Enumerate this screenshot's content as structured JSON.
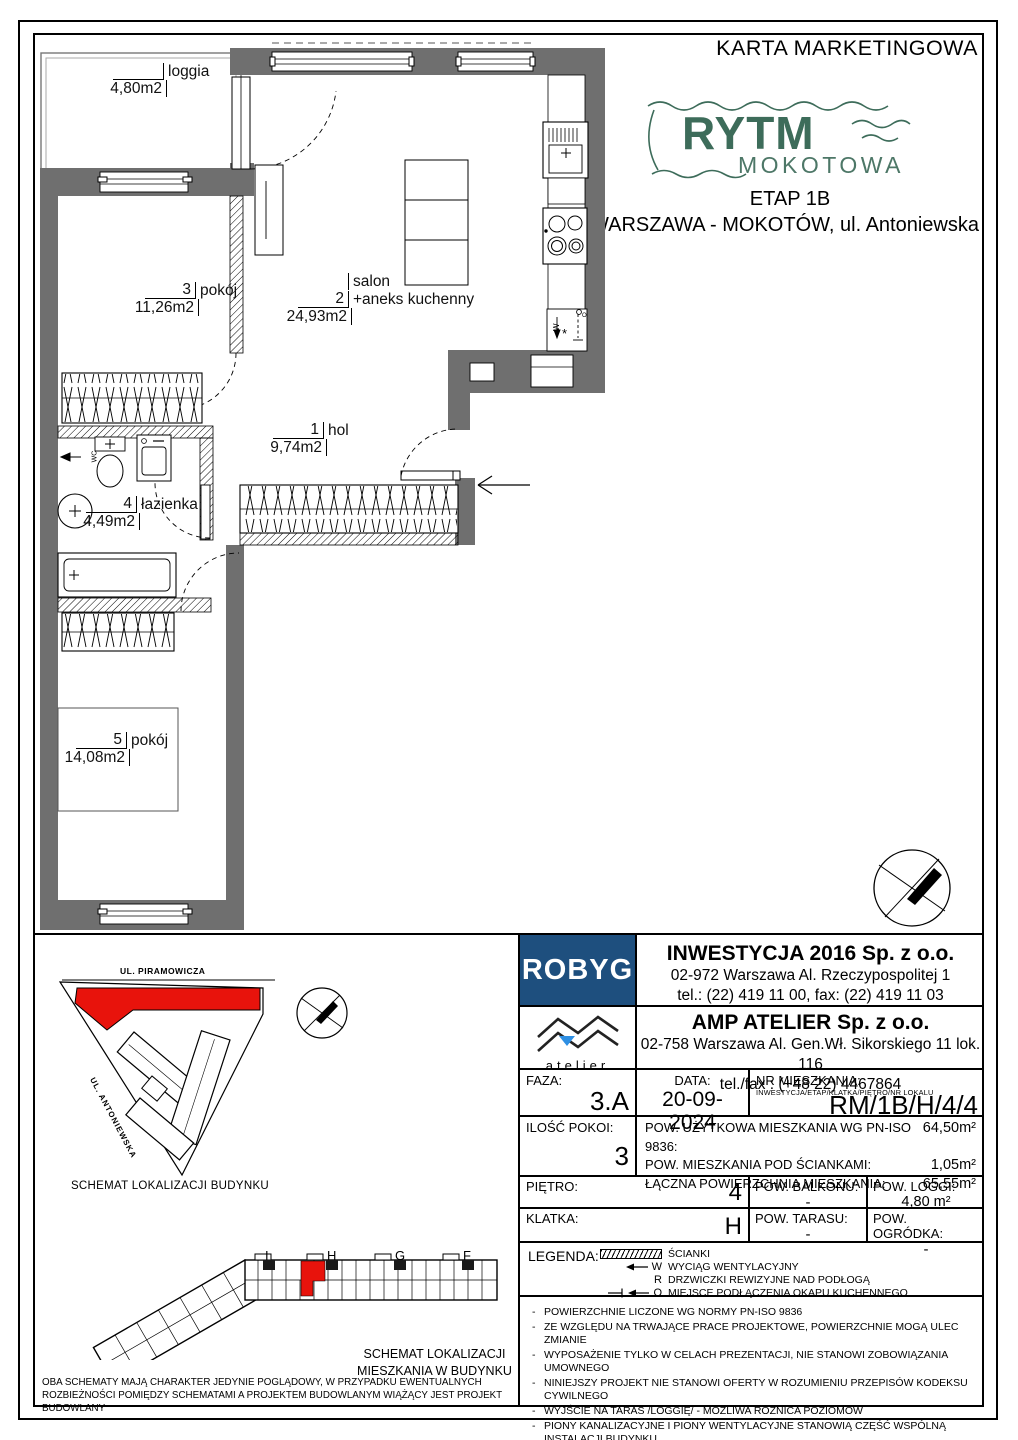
{
  "header": {
    "title": "KARTA MARKETINGOWA",
    "etap": "ETAP 1B",
    "location": "WARSZAWA - MOKOTÓW, ul. Antoniewska"
  },
  "brand": {
    "line1": "RYTM",
    "line2": "MOKOTOWA"
  },
  "floorplan": {
    "rooms": {
      "loggia": {
        "num": "",
        "name": "loggia",
        "area": "4,80m2"
      },
      "p3": {
        "num": "3",
        "name": "pokój",
        "area": "11,26m2"
      },
      "salon": {
        "pre": "salon",
        "num": "2",
        "name": "+aneks kuchenny",
        "area": "24,93m2"
      },
      "hol": {
        "num": "1",
        "name": "hol",
        "area": "9,74m2"
      },
      "lazienka": {
        "num": "4",
        "name": "łazienka",
        "area": "4,49m2"
      },
      "p5": {
        "num": "5",
        "name": "pokój",
        "area": "14,08m2"
      }
    },
    "wc": "WC",
    "symbols": {
      "w": "W",
      "o": "O"
    }
  },
  "site_plan": {
    "street_top": "UL. PIRAMOWICZA",
    "street_left": "UL. ANTONIEWSKA",
    "caption": "SCHEMAT LOKALIZACJI BUDYNKU"
  },
  "building_plan": {
    "staircases": [
      "I",
      "H",
      "G",
      "F"
    ],
    "caption1": "SCHEMAT LOKALIZACJI",
    "caption2": "MIESZKANIA W BUDYNKU"
  },
  "disclaimer": "OBA SCHEMATY MAJĄ CHARAKTER JEDYNIE POGLĄDOWY, W PRZYPADKU EWENTUALNYCH ROZBIEŻNOŚCI POMIĘDZY SCHEMATAMI A PROJEKTEM BUDOWLANYM WIĄŻĄCY JEST PROJEKT BUDOWLANY",
  "developer": {
    "logo": "ROBYG",
    "name": "INWESTYCJA 2016 Sp. z o.o.",
    "address": "02-972 Warszawa Al. Rzeczypospolitej 1",
    "phone": "tel.: (22) 419 11 00, fax: (22) 419 11 03"
  },
  "architect": {
    "logo": "atelier",
    "name": "AMP ATELIER Sp. z o.o.",
    "address": "02-758 Warszawa Al. Gen.Wł. Sikorskiego 11 lok. 116",
    "phone": "tel./fax : (+48 22) 4467864"
  },
  "details": {
    "faza_label": "FAZA:",
    "faza": "3.A",
    "data_label": "DATA:",
    "data": "20-09-2024",
    "nr_label": "NR MIESZKANIA:",
    "nr_sublabel": "INWESTYCJA/ETAP/KLATKA/PIĘTRO/NR LOKALU",
    "nr": "RM/1B/H/4/4",
    "rooms_label": "ILOŚĆ POKOI:",
    "rooms": "3",
    "area_rows": [
      {
        "label": "POW. UŻYTKOWA MIESZKANIA WG PN-ISO 9836:",
        "value": "64,50m²"
      },
      {
        "label": "POW. MIESZKANIA POD ŚCIANKAMI:",
        "value": "1,05m²"
      },
      {
        "label": "ŁĄCZNA POWIERZCHNIA MIESZKANIA:",
        "value": "65,55m²"
      }
    ],
    "pietro_label": "PIĘTRO:",
    "pietro": "4",
    "balkon_label": "POW. BALKONU:",
    "balkon": "-",
    "loggia_label": "POW. LOGGI:",
    "loggia": "4,80 m²",
    "klatka_label": "KLATKA:",
    "klatka": "H",
    "taras_label": "POW. TARASU:",
    "taras": "-",
    "ogrodek_label": "POW. OGRÓDKA:",
    "ogrodek": "-"
  },
  "legend": {
    "label": "LEGENDA:",
    "items": [
      {
        "symbol": "",
        "text": "ŚCIANKI"
      },
      {
        "symbol": "W",
        "text": "WYCIĄG WENTYLACYJNY"
      },
      {
        "symbol": "R",
        "text": "DRZWICZKI REWIZYJNE NAD PODŁOGĄ"
      },
      {
        "symbol": "O",
        "text": "MIEJSCE PODŁĄCZENIA OKAPU KUCHENNEGO"
      }
    ]
  },
  "notes": [
    "POWIERZCHNIE LICZONE WG NORMY PN-ISO 9836",
    "ZE WZGLĘDU NA TRWAJĄCE PRACE PROJEKTOWE, POWIERZCHNIE MOGĄ ULEC ZMIANIE",
    "WYPOSAŻENIE TYLKO W CELACH PREZENTACJI, NIE STANOWI ZOBOWIĄZANIA UMOWNEGO",
    "NINIEJSZY PROJEKT NIE STANOWI OFERTY W ROZUMIENIU PRZEPISÓW KODEKSU CYWILNEGO",
    "WYJŚCIE NA TARAS /LOGGIĘ/ - MOŻLIWA RÓŻNICA POZIOMÓW",
    "PIONY KANALIZACYJNE I PIONY WENTYLACYJNE STANOWIĄ CZĘŚĆ WSPÓLNĄ INSTALACJI BUDYNKU",
    "W PRZYPADKU WYSTĘPOWANIA OTWORU REWIZYJNEGO NA PIONIE, MUSI BYĆ ZAPEWNIONY DOSTĘP DO NIEGO, ZGODNIE Z DOKUMENTACJĄ TECHNICZNĄ"
  ],
  "colors": {
    "wall_gray": "#6f6f6f",
    "accent_red": "#e8130c",
    "brand_green": "#3d6c5a",
    "robyg_navy": "#1e4f7e",
    "atelier_blue": "#2e8fe3"
  }
}
